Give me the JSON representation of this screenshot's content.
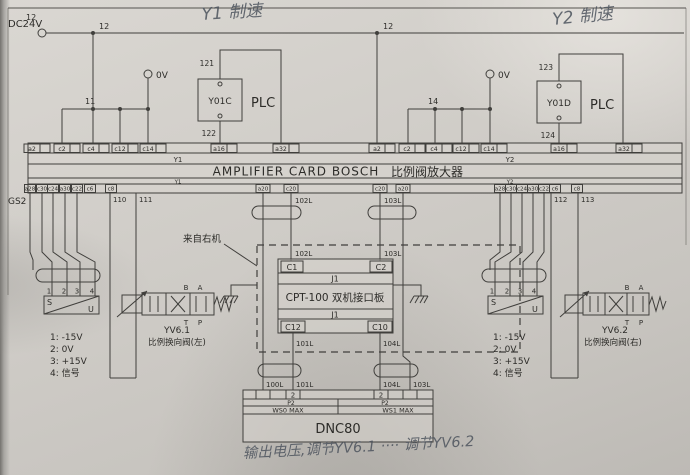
{
  "frame": {
    "zone_label": "12"
  },
  "handwriting": {
    "y1": "Y1 制速",
    "y2": "Y2 制速",
    "bottom": "输出电压,调节YV6.1 ···· 调节YV6.2"
  },
  "power": {
    "dc24v": "DC24V",
    "bus_left": "12",
    "bus_right": "12",
    "ov_left": "0V",
    "ov_right": "0V",
    "w11": "11",
    "w14": "14"
  },
  "plc_left": {
    "relay": "Y01C",
    "plc": "PLC",
    "pin_top": "121",
    "pin_bottom": "122"
  },
  "plc_right": {
    "relay": "Y01D",
    "plc": "PLC",
    "pin_top": "123",
    "pin_bottom": "124"
  },
  "card": {
    "title_en": "AMPLIFIER CARD  BOSCH",
    "title_zh": "比例阀放大器",
    "y1a": "Y1",
    "y1b": "Y1",
    "y2a": "Y2",
    "y2b": "Y2",
    "top_left": [
      "a2",
      "c2",
      "c4",
      "c12",
      "c14",
      "a16",
      "a32"
    ],
    "top_right": [
      "a2",
      "c2",
      "c4",
      "c12",
      "c14",
      "a16",
      "a32"
    ],
    "bottom_left": [
      "a28",
      "c30",
      "c24",
      "a30",
      "c22",
      "c6",
      "c8",
      "a20",
      "c20"
    ],
    "bottom_right": [
      "c20",
      "a20",
      "a28",
      "c30",
      "c24",
      "a30",
      "c22",
      "c6",
      "c8"
    ],
    "gs2": "GS2"
  },
  "left_branch": {
    "w110": "110",
    "w111": "111",
    "pins": [
      "1",
      "2",
      "3",
      "4"
    ],
    "s": "S",
    "u": "U",
    "legend": [
      "1:  -15V",
      "2:  0V",
      "3:  +15V",
      "4:  信号"
    ],
    "valve_id": "YV6.1",
    "valve_name": "比例换向阀(左)",
    "port_b": "B",
    "port_a": "A",
    "port_t": "T",
    "port_p": "P"
  },
  "right_branch": {
    "w112": "112",
    "w113": "113",
    "pins": [
      "1",
      "2",
      "3",
      "4"
    ],
    "s": "S",
    "u": "U",
    "legend": [
      "1:  -15V",
      "2:  0V",
      "3:  +15V",
      "4:  信号"
    ],
    "valve_id": "YV6.2",
    "valve_name": "比例换向阀(右)",
    "port_b": "B",
    "port_a": "A",
    "port_t": "T",
    "port_p": "P"
  },
  "interface": {
    "note": "来自右机",
    "title": "CPT-100   双机接口板",
    "j1a": "J1",
    "j1b": "J1",
    "c1": "C1",
    "c2": "C2",
    "c12": "C12",
    "c10": "C10",
    "w102a": "102L",
    "w103a": "103L",
    "w102b": "102L",
    "w103b": "103L",
    "w101": "101L",
    "w104": "104L"
  },
  "dnc": {
    "w100": "100L",
    "w101": "101L",
    "w104": "104L",
    "w103": "103L",
    "ch_left": "2",
    "ch_right": "2",
    "p2_left": "P2",
    "p2_right": "P2",
    "ws0": "WS0 MAX",
    "ws1": "WS1 MAX",
    "title": "DNC80"
  }
}
